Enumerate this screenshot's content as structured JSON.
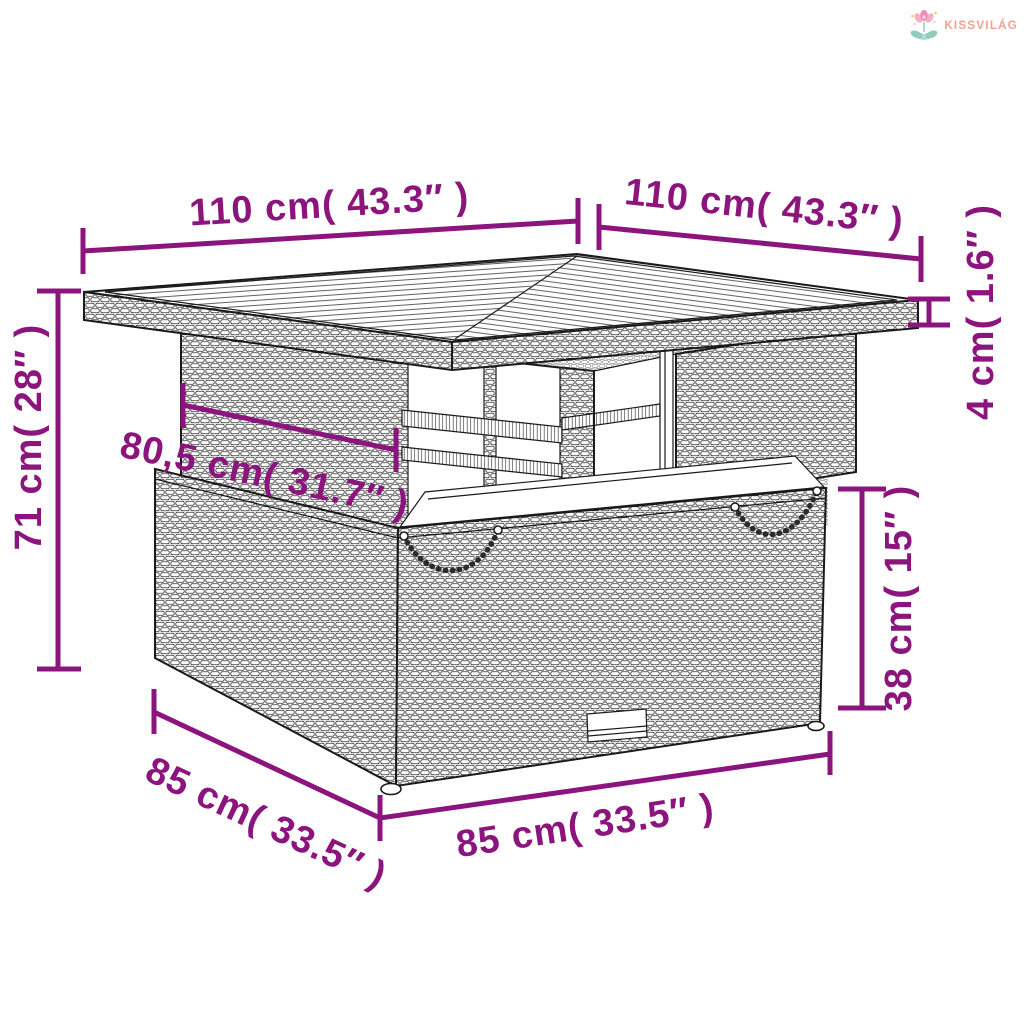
{
  "brand": {
    "name": "KISSVILÁG",
    "color": "#F0A291",
    "icon": "flower-logo-icon"
  },
  "diagram": {
    "type": "product-dimension-diagram",
    "subject": "poly-rattan garden table line drawing",
    "accent_color": "#8C147D",
    "line_color": "#1a1a1a",
    "dimensions": [
      {
        "id": "top-width-left",
        "label": "110 cm( 43.3″ )"
      },
      {
        "id": "top-width-right",
        "label": "110 cm( 43.3″ )"
      },
      {
        "id": "tabletop-thickness",
        "label": "4 cm( 1.6″ )"
      },
      {
        "id": "total-height",
        "label": "71 cm( 28″ )"
      },
      {
        "id": "inner-width",
        "label": "80,5 cm( 31.7″ )"
      },
      {
        "id": "base-height",
        "label": "38 cm( 15″ )"
      },
      {
        "id": "base-depth",
        "label": "85 cm( 33.5″ )"
      },
      {
        "id": "base-width",
        "label": "85 cm( 33.5″ )"
      }
    ]
  }
}
